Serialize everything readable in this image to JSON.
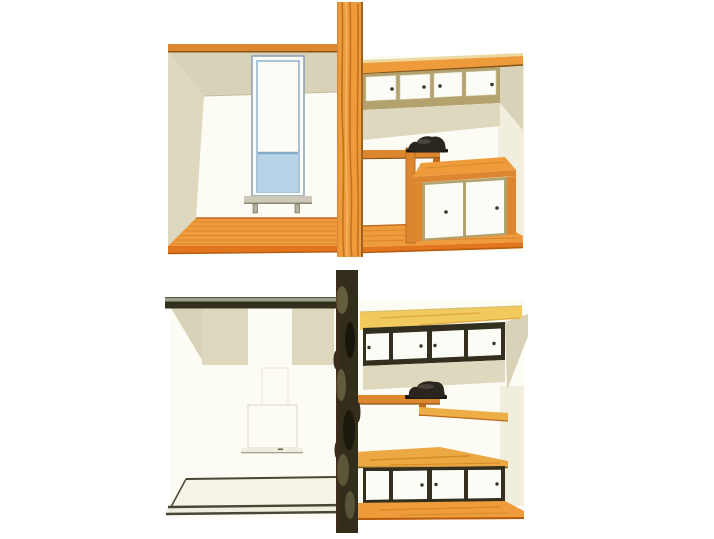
{
  "meta": {
    "type": "watercolor-interior-perspective-illustrations",
    "panel_count": 2,
    "visible_text": "none"
  },
  "colors": {
    "paper": "#ffffff",
    "wall_white": "#fdfcf4",
    "wall_cream": "#f1eede",
    "beige": "#d8d2b8",
    "beige_light": "#ded8bf",
    "beige_edge": "#c2bca0",
    "wood": "#ee9b3c",
    "wood_mid": "#dc8630",
    "wood_dark": "#bd6a1c",
    "wood_deep": "#8a5618",
    "wood_light": "#f4b766",
    "wood_pale": "#ecd9a0",
    "fascia": "#e2761f",
    "fascia_dark": "#b85c10",
    "frame_tan": "#b3a26e",
    "door_white": "#fcfcf6",
    "door_edge": "#d8d0b0",
    "handle_dark": "#3a342a",
    "window_frame": "#8ea6ba",
    "window_blue": "#b6d3e7",
    "window_blue_dark": "#84aac8",
    "window_inner": "#a9c4d8",
    "sill_gray": "#cdc8b8",
    "sill_shadow": "#8e8876",
    "hook_gray": "#b4ae9c",
    "hook_edge": "#6a654f",
    "object_black": "#2a251d",
    "object_base": "#1e1a12",
    "object_highlight": "#5e574b",
    "dark_post": "#332e1c",
    "post_light": "#6e6a46",
    "post_deep": "#191509",
    "post_khaki": "#7d7a52",
    "maroon": "#5c241a",
    "beam_dark": "#33301e",
    "beam_highlight": "#9aa08c",
    "beam_line": "#55523a",
    "dark_frame": "#332f1f",
    "floor_line_dark": "#4a4634",
    "pale_floor": "#f6f4e8",
    "pale_floor_band": "#efede0",
    "yellow_wood": "#f2c95c",
    "yellow_wood_streak": "#e0a93c",
    "yellow_wood_edge": "#d8c070",
    "counter_wood": "#eca843",
    "counter_streak": "#d58a28",
    "counter_edge": "#7a5a20",
    "shelf_light": "#eeae46",
    "faint_line": "#dedac8",
    "faint_line2": "#e9e6d8"
  },
  "panels": {
    "top": {
      "name": "furnished-room-with-wooden-pillar-and-cabinets",
      "left_room": {
        "window": "tall-vertical-window-blue-glass-lower-pane",
        "sill_hooks": 2,
        "walls": "white-with-beige-ceiling-cove",
        "floor": "orange-wood-planks"
      },
      "pillar": "orange-wood-grain-post",
      "right_section": {
        "upper_sliding_doors": 4,
        "chest_sliding_doors": 2,
        "shelf_object": "dark-object-on-wall-shelf",
        "floor": "orange-wood-planks"
      }
    },
    "bottom": {
      "name": "bare-room-with-dark-rustic-post-and-cabinets",
      "left_room": {
        "beam": "dark-horizontal-beam",
        "window": "faint-window-outline-with-sill",
        "walls": "white-with-beige-patches",
        "floor": "pale-floor-dark-edge-lines"
      },
      "pillar": "dark-mottled-rustic-post",
      "right_section": {
        "upper_sliding_doors": 4,
        "lower_sliding_doors": 4,
        "shelf_object": "dark-object-on-wall-shelf",
        "floor": "orange-wood-planks"
      }
    }
  }
}
